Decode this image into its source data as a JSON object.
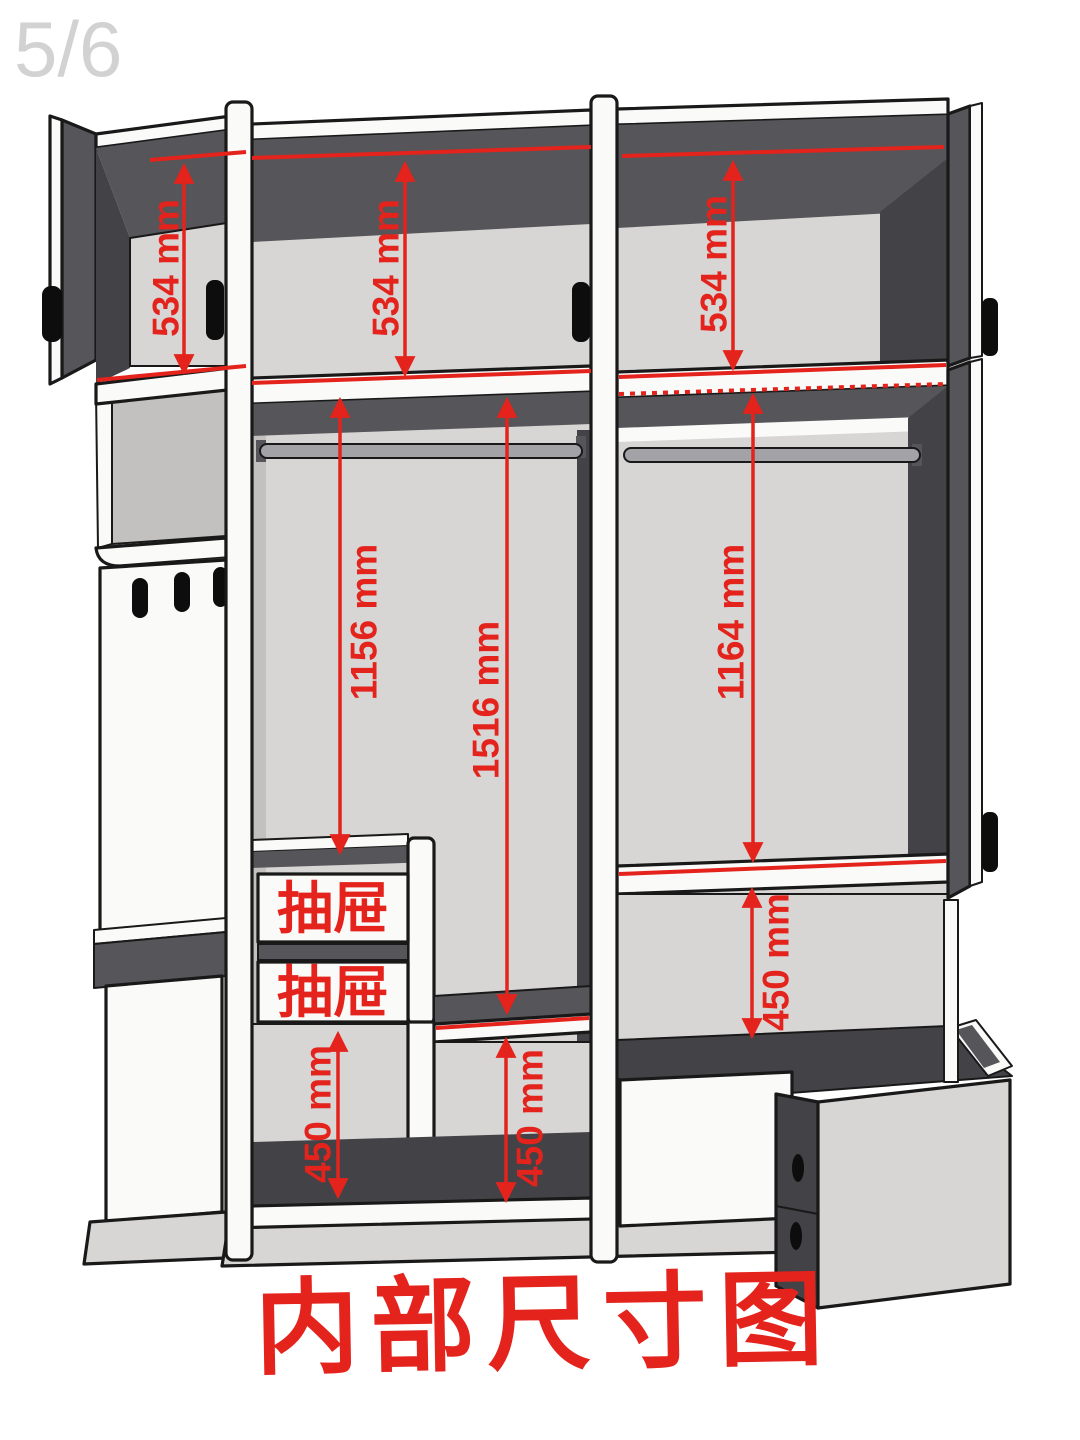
{
  "page": {
    "indicator": "5/6",
    "title": "内部尺寸图"
  },
  "colors": {
    "annotation_red": "#e3231c",
    "panel_white": "#fafaf9",
    "panel_light_gray": "#d7d6d5",
    "panel_mid_gray": "#c2c1c0",
    "panel_dark_gray": "#565559",
    "outline_black": "#191919",
    "page_indicator_gray": "#d2d2d2",
    "background": "#ffffff"
  },
  "dimensions": {
    "top_left_shelf": "534 mm",
    "top_middle_shelf": "534 mm",
    "top_right_shelf": "534 mm",
    "left_hanging_to_drawers": "1156 mm",
    "left_hanging_to_shelf": "1516 mm",
    "right_hanging": "1164 mm",
    "bottom_left_compartment": "450 mm",
    "bottom_middle_compartment": "450 mm",
    "bottom_right_compartment": "450 mm"
  },
  "labels": {
    "drawer_upper": "抽屉",
    "drawer_lower": "抽屉"
  }
}
